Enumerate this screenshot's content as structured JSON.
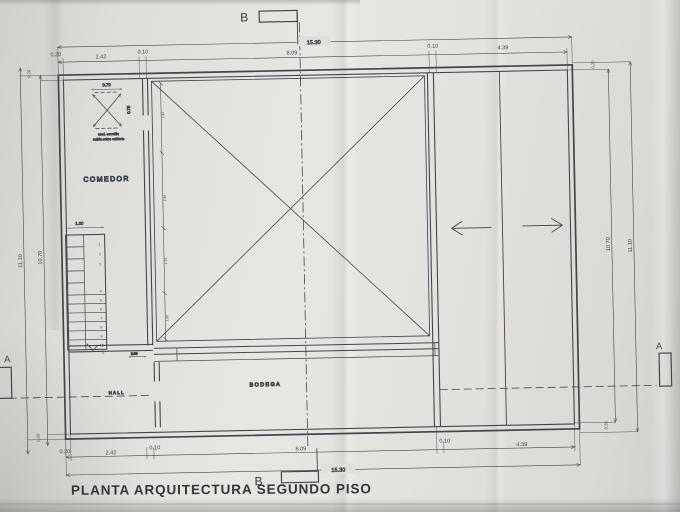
{
  "title": "PLANTA ARQUITECTURA SEGUNDO PISO",
  "section_markers": {
    "top_b": "B",
    "bottom_b": "B",
    "left_a": "A",
    "right_a": "A"
  },
  "rooms": {
    "comedor": "COMEDOR",
    "bodega": "BODEGA",
    "hall": "HALL"
  },
  "dims": {
    "top_total": "15.30",
    "top_chain": [
      "0.20",
      "2.42",
      "0.10",
      "8.09",
      "0.10",
      "4.39"
    ],
    "bottom_total": "15.30",
    "bottom_chain": [
      "0.20",
      "2.42",
      "0.10",
      "8.09",
      "0.10",
      "4.39"
    ],
    "left_outer": "11.10",
    "left_inner": "10.70",
    "right_inner": "10.70",
    "right_outer": "11.10",
    "wall_top_left": "0.20",
    "wall_bottom_left": "0.20",
    "wall_top_right": "0.20",
    "wall_bottom_right": "0.20",
    "stair_width": "1.00",
    "hatch_width": "0.70",
    "hatch_height": "0.75",
    "bench_height": "0.60",
    "interior_chain": [
      "1.90",
      "1.98",
      "1.70",
      "1.60"
    ]
  },
  "stairs": {
    "steps": [
      "1",
      "2",
      "3",
      "4",
      "5",
      "6",
      "7",
      "8",
      "9",
      "10",
      "11"
    ]
  },
  "hatch_note": {
    "line1": "med. escotilla",
    "line2": "salida sobre cubierta"
  },
  "colors": {
    "paper": "#e3e2de",
    "line": "#40454d",
    "title": "#33363b"
  }
}
